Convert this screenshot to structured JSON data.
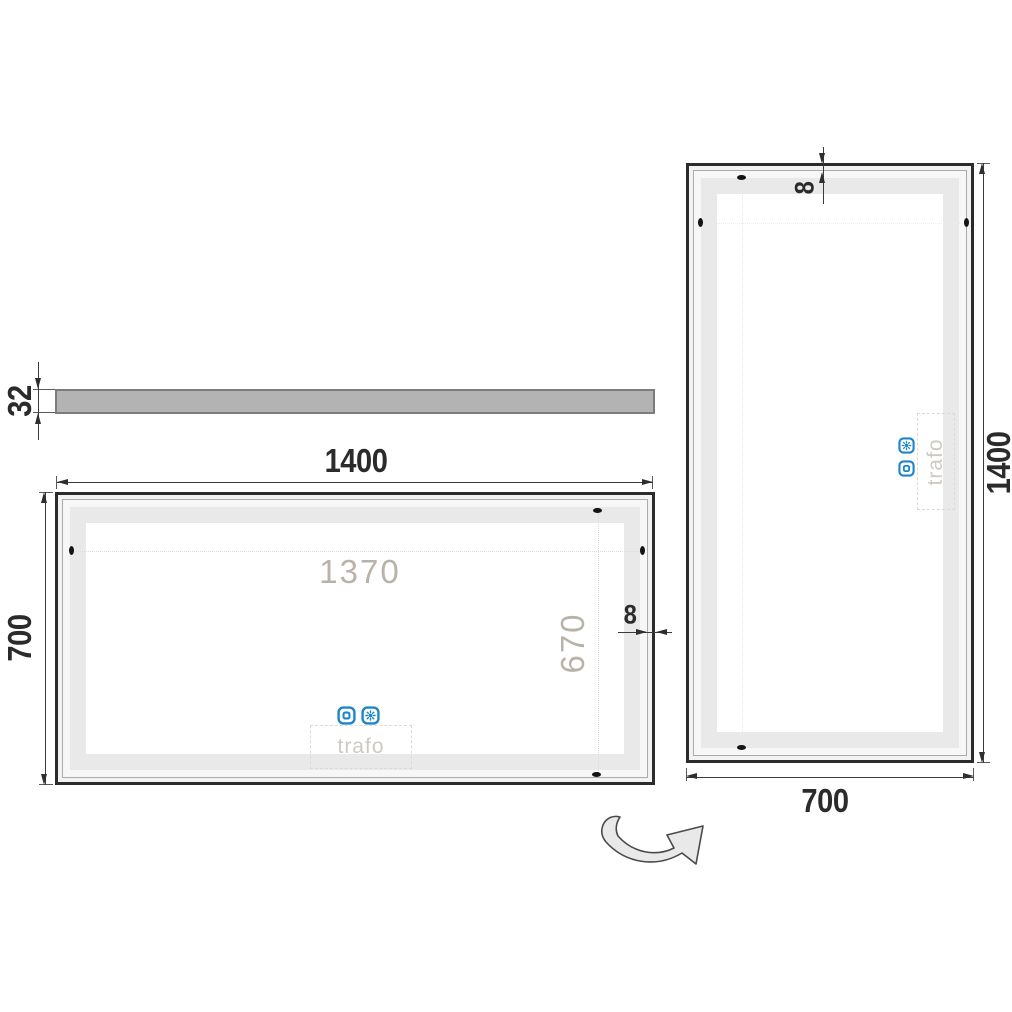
{
  "views": {
    "side": {
      "thickness": "32"
    },
    "front": {
      "width": "1400",
      "height": "700",
      "led_width": "1370",
      "led_height": "670",
      "frame": "8",
      "trafo": "trafo"
    },
    "rotated": {
      "height": "1400",
      "width": "700",
      "frame": "8",
      "trafo": "trafo"
    }
  },
  "icons": {
    "touch_switch": "touch-switch-icon",
    "brightness": "brightness-icon",
    "rotate": "rotate-arrow-icon"
  },
  "colors": {
    "accent": "#1d86c8",
    "frame": "#2b2b2b",
    "led_band": "#e9e9e9",
    "dimension_text": "#2b2b2b",
    "ghost_text": "#b8b2a8",
    "bar_fill": "#b3b3b3"
  }
}
